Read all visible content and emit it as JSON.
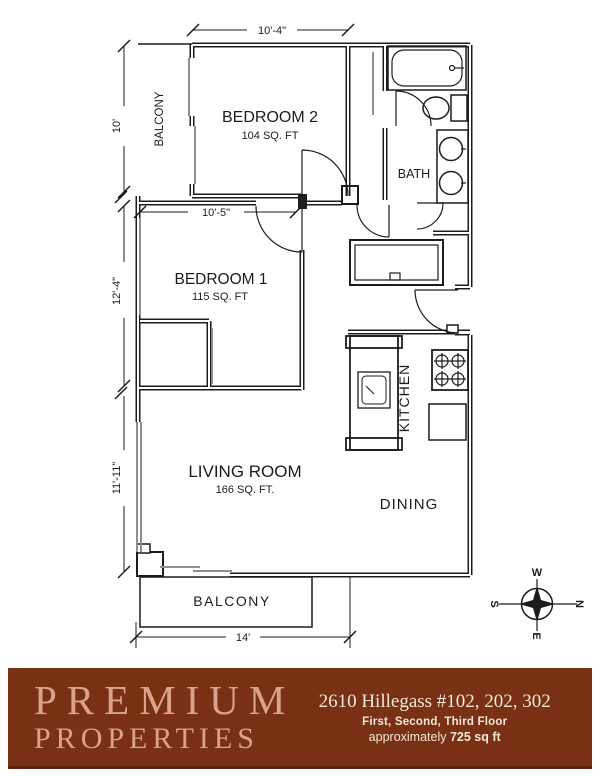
{
  "plan": {
    "rooms": {
      "bedroom2": {
        "label": "BEDROOM 2",
        "area": "104 SQ. FT"
      },
      "bedroom1": {
        "label": "BEDROOM 1",
        "area": "115 SQ. FT"
      },
      "living_room": {
        "label": "LIVING ROOM",
        "area": "166 SQ. FT."
      },
      "bath": {
        "label": "BATH"
      },
      "kitchen": {
        "label": "KITCHEN"
      },
      "dining": {
        "label": "DINING"
      },
      "balcony_top": {
        "label": "BALCONY"
      },
      "balcony_bottom": {
        "label": "BALCONY"
      }
    },
    "dimensions": {
      "bedroom2_width": "10'-4\"",
      "balcony_height": "10'",
      "bedroom1_width": "10'-5\"",
      "bedroom1_height": "12'-4\"",
      "living_height": "11'-11\"",
      "bottom_width": "14'"
    },
    "compass": {
      "top": "W",
      "right": "N",
      "left": "S",
      "bottom": "E"
    }
  },
  "footer": {
    "brand_line1": "PREMIUM",
    "brand_line2": "PROPERTIES",
    "address": "2610 Hillegass #102, 202, 302",
    "floors": "First, Second, Third Floor",
    "area_prefix": "approximately ",
    "area_bold": "725 sq ft",
    "colors": {
      "banner_background": "#7a3014",
      "brand_text": "#d9a28c",
      "info_text": "#f2e9d8",
      "drawing_lines": "#1c1c1c"
    }
  }
}
